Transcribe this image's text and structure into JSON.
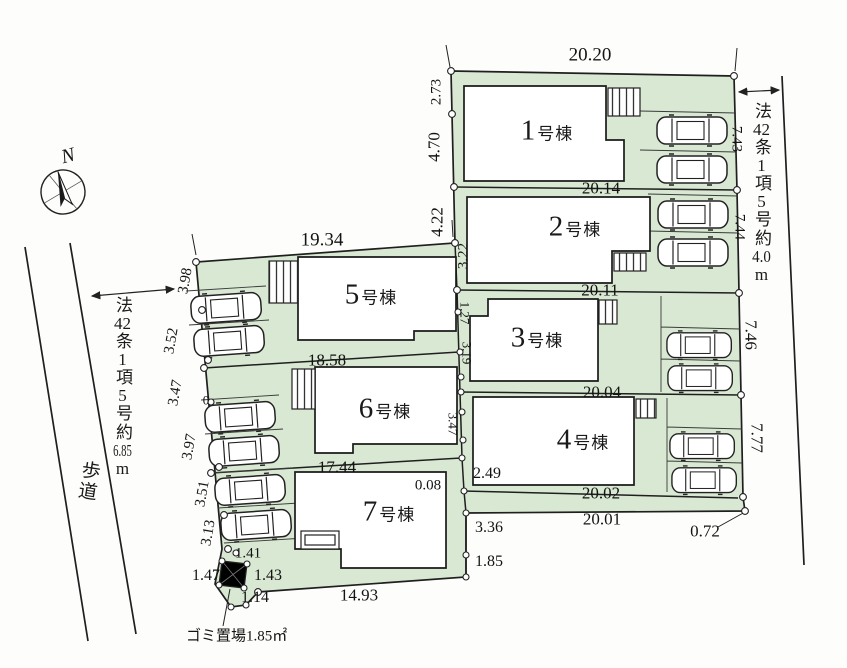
{
  "site": {
    "compass_label": "N",
    "road_left_label": "歩道",
    "garbage_label": "ゴミ置場1.85㎡",
    "regulation_left": {
      "parts": [
        "法",
        "42",
        "条",
        "1",
        "項",
        "5",
        "号",
        "約",
        "6.85",
        "m"
      ]
    },
    "regulation_right": {
      "parts": [
        "法",
        "42",
        "条",
        "1",
        "項",
        "5",
        "号",
        "約",
        "4.0",
        "m"
      ]
    },
    "lot_fill_color": "#d9e8d2",
    "line_color": "#1f1f1f"
  },
  "buildings": [
    {
      "num": "1",
      "suffix": "号棟"
    },
    {
      "num": "2",
      "suffix": "号棟"
    },
    {
      "num": "3",
      "suffix": "号棟"
    },
    {
      "num": "4",
      "suffix": "号棟"
    },
    {
      "num": "5",
      "suffix": "号棟"
    },
    {
      "num": "6",
      "suffix": "号棟"
    },
    {
      "num": "7",
      "suffix": "号棟"
    }
  ],
  "dims": {
    "d20_20": "20.20",
    "d20_14": "20.14",
    "d20_11": "20.11",
    "d20_04": "20.04",
    "d20_02": "20.02",
    "d20_01": "20.01",
    "d19_34": "19.34",
    "d18_58": "18.58",
    "d17_44": "17.44",
    "d14_93": "14.93",
    "d2_73": "2.73",
    "d4_70": "4.70",
    "d4_22": "4.22",
    "d3_22": "3.22",
    "d7_43": "7.43",
    "d7_44": "7.44",
    "d7_46": "7.46",
    "d7_77": "7.77",
    "d1_27": "1.27",
    "d3_19": "3.19",
    "d3_47_mid": "3.47",
    "d3_98": "3.98",
    "d3_52": "3.52",
    "d3_47": "3.47",
    "d0": "0",
    "d3_97": "3.97",
    "d3_51": "3.51",
    "d3_13": "3.13",
    "d1_41": "1.41",
    "d1_47": "1.47",
    "d1_43": "1.43",
    "d1_14": "1.14",
    "d0_08": "0.08",
    "d2_49": "2.49",
    "d3_36": "3.36",
    "d1_85": "1.85",
    "d0_72": "0.72"
  }
}
